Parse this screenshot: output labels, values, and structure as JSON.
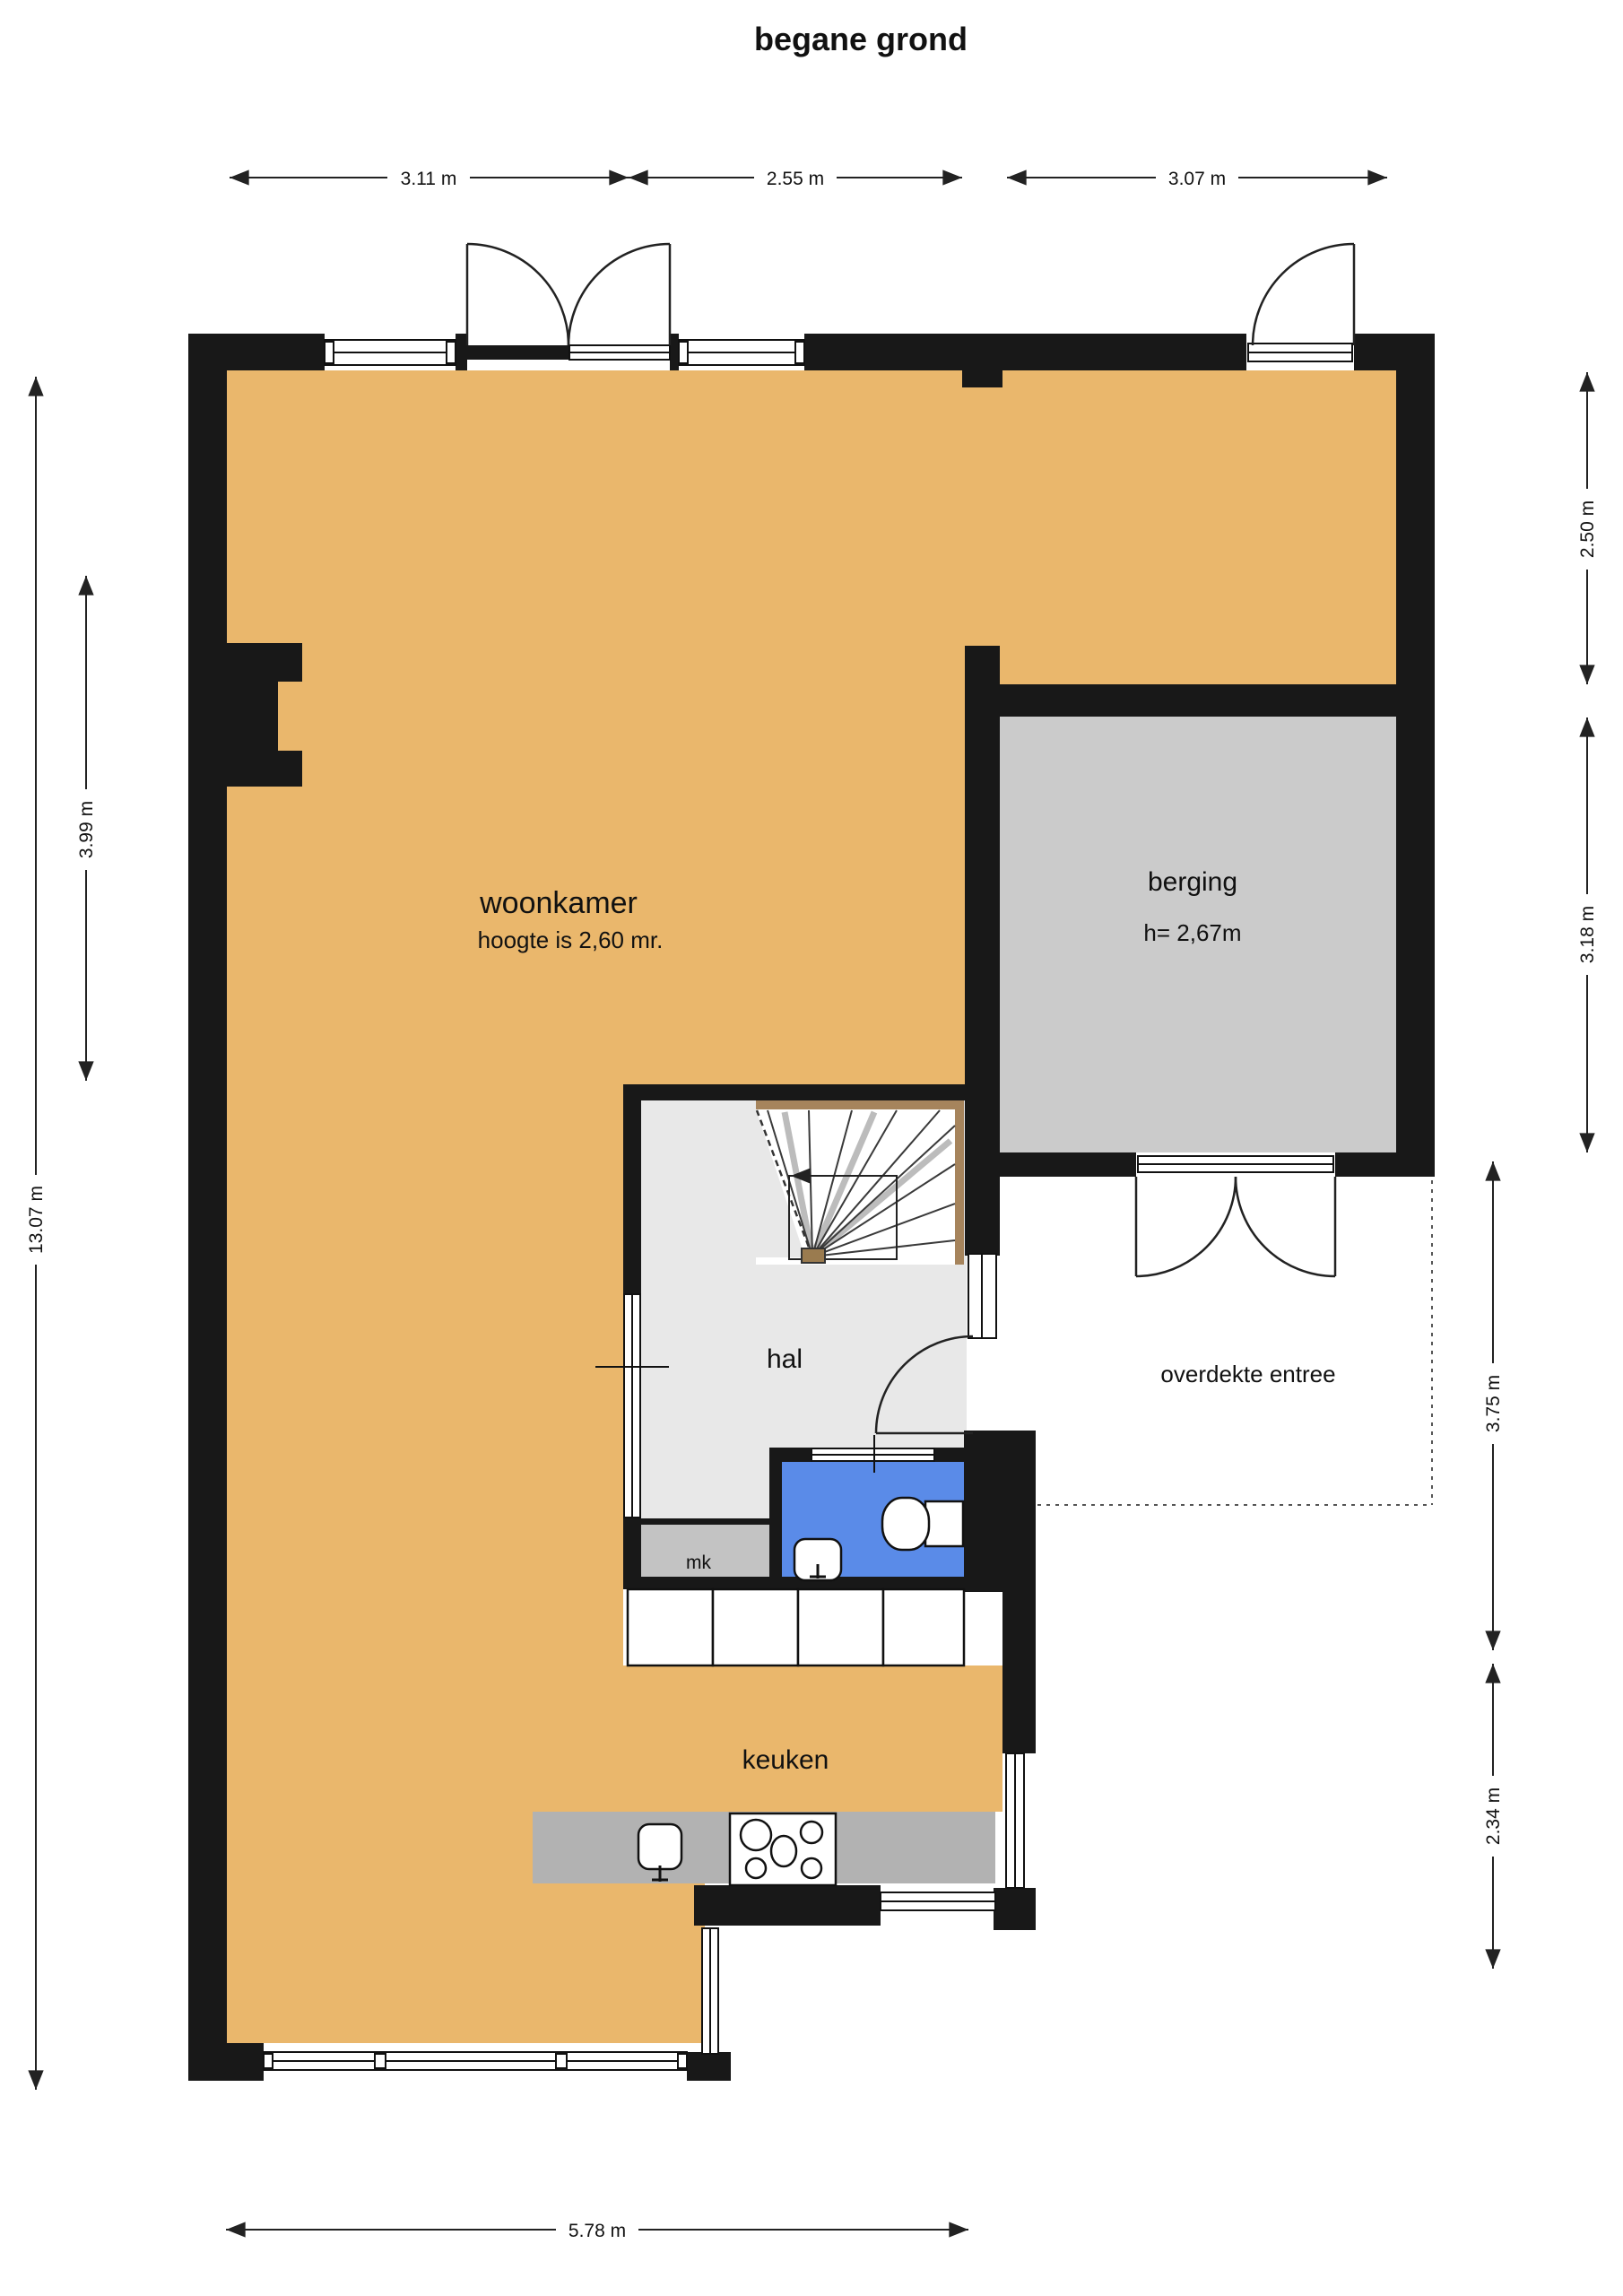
{
  "title": "begane grond",
  "rooms": {
    "woonkamer": {
      "label": "woonkamer",
      "height_note": "hoogte is 2,60 mr."
    },
    "berging": {
      "label": "berging",
      "height_note": "h= 2,67m"
    },
    "hal": {
      "label": "hal"
    },
    "meterkast": {
      "label": "mk"
    },
    "keuken": {
      "label": "keuken"
    },
    "overdekte_entree": {
      "label": "overdekte entree"
    }
  },
  "dimensions": {
    "top_left": "3.11 m",
    "top_middle": "2.55 m",
    "top_right": "3.07 m",
    "left_overall": "13.07 m",
    "left_woonkamer": "3.99 m",
    "right_upper": "2.50 m",
    "right_berging": "3.18 m",
    "right_entree": "3.75 m",
    "right_keuken": "2.34 m",
    "bottom": "5.78 m"
  },
  "colors": {
    "floor": "#EAB76C",
    "berging-floor": "#CBCBCB",
    "hal-floor": "#E8E8E8",
    "mk-floor": "#C3C3C3",
    "toilet-floor": "#5A8BE8",
    "counter": "#B2B2B2",
    "wall": "#181818",
    "stair-trim": "#A6845C",
    "stair-post": "#9A7B4F",
    "dash": "#555555",
    "dim": "#222222"
  }
}
